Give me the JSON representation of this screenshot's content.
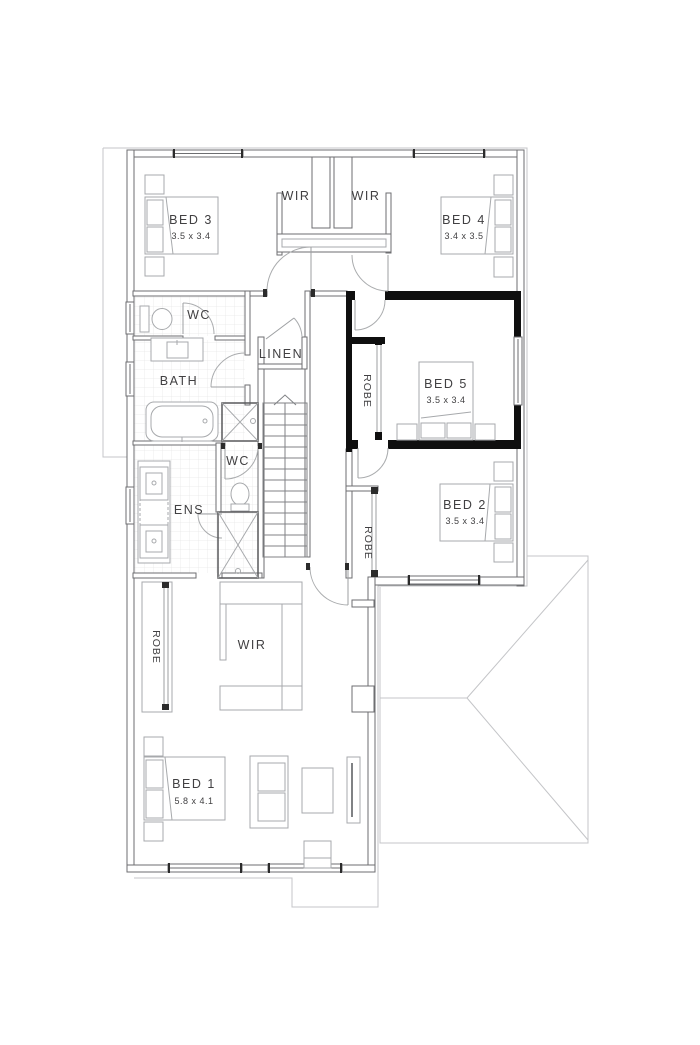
{
  "rooms": {
    "bed1": {
      "name": "BED 1",
      "dims": "5.8 x 4.1"
    },
    "bed2": {
      "name": "BED 2",
      "dims": "3.5 x 3.4"
    },
    "bed3": {
      "name": "BED 3",
      "dims": "3.5 x 3.4"
    },
    "bed4": {
      "name": "BED 4",
      "dims": "3.4 x 3.5"
    },
    "bed5": {
      "name": "BED 5",
      "dims": "3.5 x 3.4"
    },
    "bath": {
      "label": "BATH"
    },
    "ens": {
      "label": "ENS"
    },
    "wc_upper": {
      "label": "WC"
    },
    "wc_ens": {
      "label": "WC"
    },
    "linen": {
      "label": "LINEN"
    },
    "wir_top_left": {
      "label": "WIR"
    },
    "wir_top_right": {
      "label": "WIR"
    },
    "wir_master": {
      "label": "WIR"
    },
    "robe_bed5": {
      "label": "ROBE"
    },
    "robe_bed2": {
      "label": "ROBE"
    },
    "robe_bed1": {
      "label": "ROBE"
    }
  },
  "colors": {
    "wall": "#6d6e71",
    "highlight_wall": "#0f0f0f",
    "eave": "#c4c5c8",
    "furniture": "#a7a9ac",
    "tile": "#e6e6e7",
    "text": "#414042",
    "background": "#ffffff"
  }
}
